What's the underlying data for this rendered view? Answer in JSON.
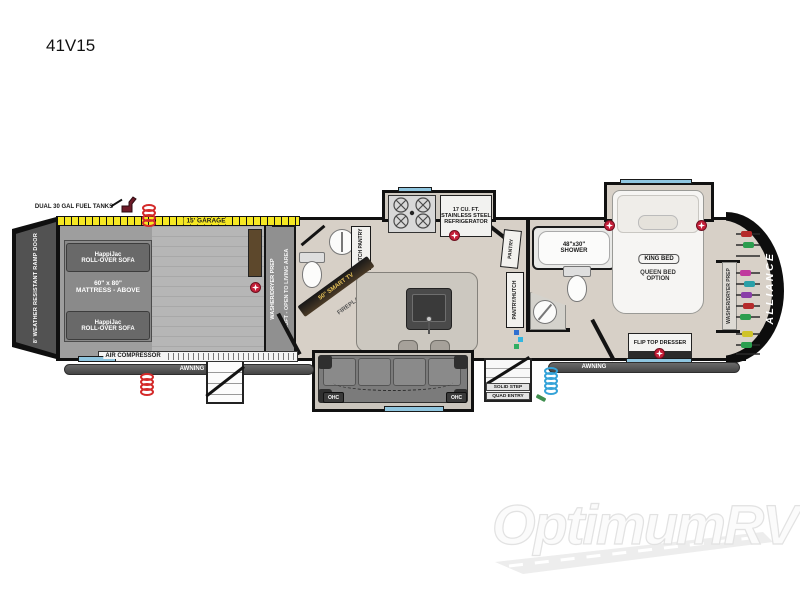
{
  "title": "41V15",
  "watermark": "OptimumRV",
  "colors": {
    "tape_yellow": "#f6e823",
    "window_blue": "#8fc6e0",
    "hookup_red": "#c5203a",
    "coil_red": "#d42a2a",
    "hose_blue": "#35a3d8",
    "garage_door_brown": "#5d482c",
    "wall_black": "#131313",
    "garage_floor": "#9e9e9e",
    "living_floor": "#d7d0c7"
  },
  "icons": {
    "fuel_pump_icon": "fuel nozzle shape",
    "tv_hookup_icon": "red circle with white star",
    "spring_hose_icon": "coiled hose rings",
    "clothes_hangers_icon": "hanger bars with colored garments",
    "burner_icon": "stove burner circles",
    "road_icon": "road swoosh under watermark"
  },
  "plan": {
    "ramp_door": "8' WEATHER RESISTANT RAMP DOOR",
    "fuel_tanks": "DUAL 30 GAL FUEL TANKS",
    "garage_tape": "15' GARAGE",
    "air_compressor": "AIR COMPRESSOR",
    "awning": "AWNING",
    "brand": "ALLIANCE",
    "garage": {
      "sofa_brand": "HappiJac",
      "sofa_type": "ROLL-OVER SOFA",
      "mattress_size": "60\" x 80\"",
      "mattress_note": "MATTRESS - ABOVE",
      "washer_dryer": "WASHER/DRYER PREP",
      "loft": "LOFT - OPEN TO LIVING AREA"
    },
    "living": {
      "hutch_pantry": "HUTCH PANTRY",
      "smart_tv": "50\" SMART TV",
      "fireplace": "FIREPLACE",
      "fridge_line1": "17 CU. FT.",
      "fridge_line2": "STAINLESS STEEL",
      "fridge_line3": "REFRIGERATOR",
      "pantry": "PANTRY",
      "pantry_hutch": "PANTRY/HUTCH",
      "ohc": "OHC"
    },
    "bath": {
      "shower_size": "48\"x30\"",
      "shower": "SHOWER"
    },
    "bedroom": {
      "king_bed": "KING BED",
      "queen_line1": "QUEEN BED",
      "queen_line2": "OPTION",
      "flip_top_dresser": "FLIP TOP DRESSER",
      "washer_dryer": "WASHER/DRYER PREP"
    },
    "entry": {
      "solid_step": "SOLID STEP",
      "quad_entry": "QUAD ENTRY"
    }
  }
}
